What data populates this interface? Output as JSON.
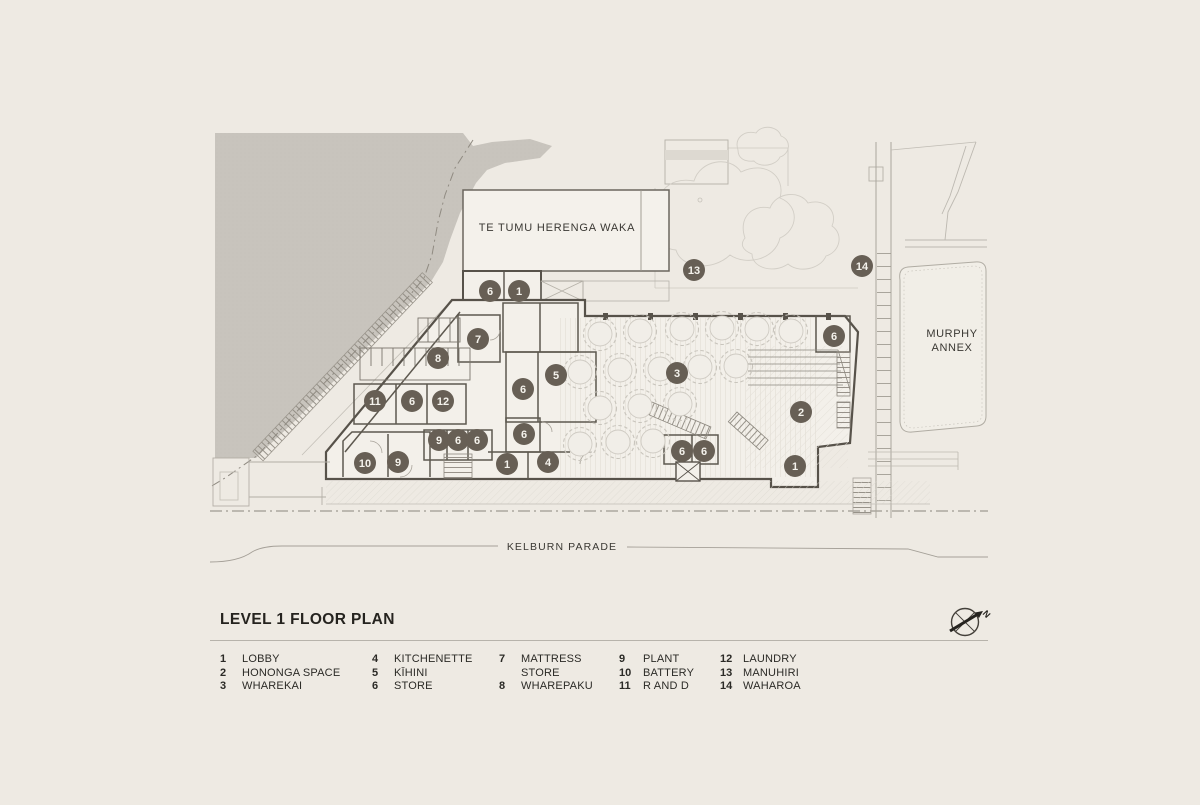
{
  "title": "LEVEL 1 FLOOR PLAN",
  "compass": {
    "north_label": "N"
  },
  "plan": {
    "buildings": {
      "te_tumu": "TE TUMU HERENGA WAKA",
      "murphy_line1": "MURPHY",
      "murphy_line2": "ANNEX"
    },
    "street": "KELBURN PARADE",
    "marker_color": "#675f55",
    "markers": [
      {
        "num": "6",
        "x": 490,
        "y": 291
      },
      {
        "num": "1",
        "x": 519,
        "y": 291
      },
      {
        "num": "13",
        "x": 694,
        "y": 270
      },
      {
        "num": "14",
        "x": 862,
        "y": 266
      },
      {
        "num": "7",
        "x": 478,
        "y": 339
      },
      {
        "num": "8",
        "x": 438,
        "y": 358
      },
      {
        "num": "5",
        "x": 556,
        "y": 375
      },
      {
        "num": "3",
        "x": 677,
        "y": 373
      },
      {
        "num": "6",
        "x": 834,
        "y": 336
      },
      {
        "num": "2",
        "x": 801,
        "y": 412
      },
      {
        "num": "11",
        "x": 375,
        "y": 401
      },
      {
        "num": "6",
        "x": 412,
        "y": 401
      },
      {
        "num": "12",
        "x": 443,
        "y": 401
      },
      {
        "num": "6",
        "x": 523,
        "y": 389
      },
      {
        "num": "6",
        "x": 524,
        "y": 434
      },
      {
        "num": "9",
        "x": 439,
        "y": 440
      },
      {
        "num": "6",
        "x": 458,
        "y": 440
      },
      {
        "num": "6",
        "x": 477,
        "y": 440
      },
      {
        "num": "10",
        "x": 365,
        "y": 463
      },
      {
        "num": "9",
        "x": 398,
        "y": 462
      },
      {
        "num": "1",
        "x": 507,
        "y": 464
      },
      {
        "num": "4",
        "x": 548,
        "y": 462
      },
      {
        "num": "6",
        "x": 682,
        "y": 451
      },
      {
        "num": "6",
        "x": 704,
        "y": 451
      },
      {
        "num": "1",
        "x": 795,
        "y": 466
      }
    ],
    "tables": [
      {
        "x": 600,
        "y": 334
      },
      {
        "x": 640,
        "y": 331
      },
      {
        "x": 682,
        "y": 329
      },
      {
        "x": 722,
        "y": 328
      },
      {
        "x": 757,
        "y": 329
      },
      {
        "x": 791,
        "y": 331
      },
      {
        "x": 580,
        "y": 372
      },
      {
        "x": 620,
        "y": 370
      },
      {
        "x": 660,
        "y": 369
      },
      {
        "x": 700,
        "y": 367
      },
      {
        "x": 736,
        "y": 366
      },
      {
        "x": 600,
        "y": 408
      },
      {
        "x": 640,
        "y": 406
      },
      {
        "x": 680,
        "y": 404
      },
      {
        "x": 580,
        "y": 444
      },
      {
        "x": 618,
        "y": 442
      },
      {
        "x": 653,
        "y": 441
      }
    ]
  },
  "legend": {
    "columns": [
      {
        "items": [
          {
            "num": "1",
            "label": "LOBBY"
          },
          {
            "num": "2",
            "label": "HONONGA SPACE"
          },
          {
            "num": "3",
            "label": "WHAREKAI"
          }
        ]
      },
      {
        "items": [
          {
            "num": "4",
            "label": "KITCHENETTE"
          },
          {
            "num": "5",
            "label": "KĪHINI"
          },
          {
            "num": "6",
            "label": "STORE"
          }
        ]
      },
      {
        "items": [
          {
            "num": "7",
            "label": "MATTRESS STORE"
          },
          {
            "num": "8",
            "label": "WHAREPAKU"
          }
        ]
      },
      {
        "items": [
          {
            "num": "9",
            "label": "PLANT"
          },
          {
            "num": "10",
            "label": "BATTERY"
          },
          {
            "num": "11",
            "label": "R AND D"
          }
        ]
      },
      {
        "items": [
          {
            "num": "12",
            "label": "LAUNDRY"
          },
          {
            "num": "13",
            "label": "MANUHIRI"
          },
          {
            "num": "14",
            "label": "WAHAROA"
          }
        ]
      }
    ]
  },
  "colors": {
    "background": "#eeeae3",
    "terrain": "#c8c4bd",
    "wall_dark": "#57524a",
    "line_mid": "#8e897f",
    "line_light": "#c6c2ba",
    "building_fill": "#f3f0ea",
    "marker": "#675f55",
    "ink": "#2f2d29"
  }
}
